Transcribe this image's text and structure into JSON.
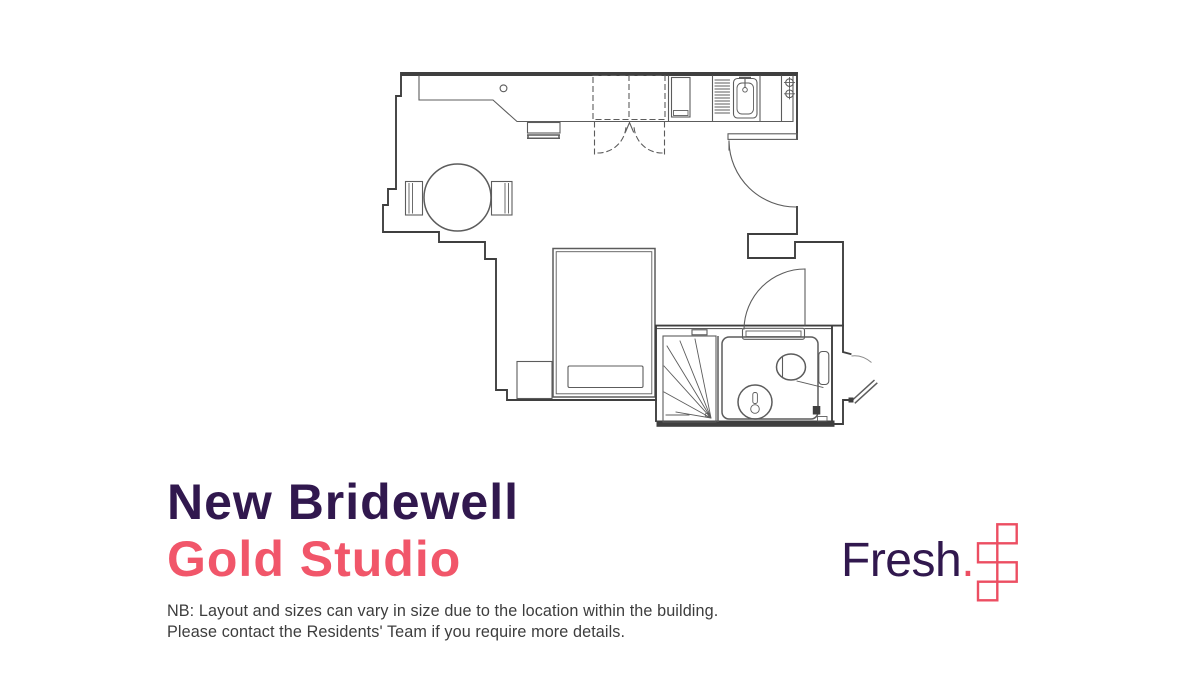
{
  "title": {
    "building": "New Bridewell",
    "unit": "Gold Studio"
  },
  "note": {
    "line1": "NB: Layout and sizes can vary in size due to the location within the building.",
    "line2": "Please contact the Residents' Team if you require more details."
  },
  "brand": {
    "name": "Fresh",
    "dot": "."
  },
  "colors": {
    "purple": "#31184e",
    "coral": "#f1566a",
    "coral_mark": "#ec4e62",
    "wall": "#3f3f3f",
    "line": "#5c5c5c",
    "line_light": "#8c8c8c",
    "note": "#3d3d3d",
    "bg": "#ffffff"
  },
  "floorplan": {
    "fixtures": [
      "kitchen-counter",
      "desk",
      "stool",
      "wardrobe",
      "fridge",
      "drainer",
      "sink",
      "tap",
      "two-ring-hob",
      "dining-table",
      "dining-chairs",
      "double-bed",
      "pillow",
      "bedside-table",
      "entrance-door",
      "shower",
      "bathroom-pod",
      "toilet",
      "basin",
      "bathroom-door",
      "external-door"
    ]
  }
}
